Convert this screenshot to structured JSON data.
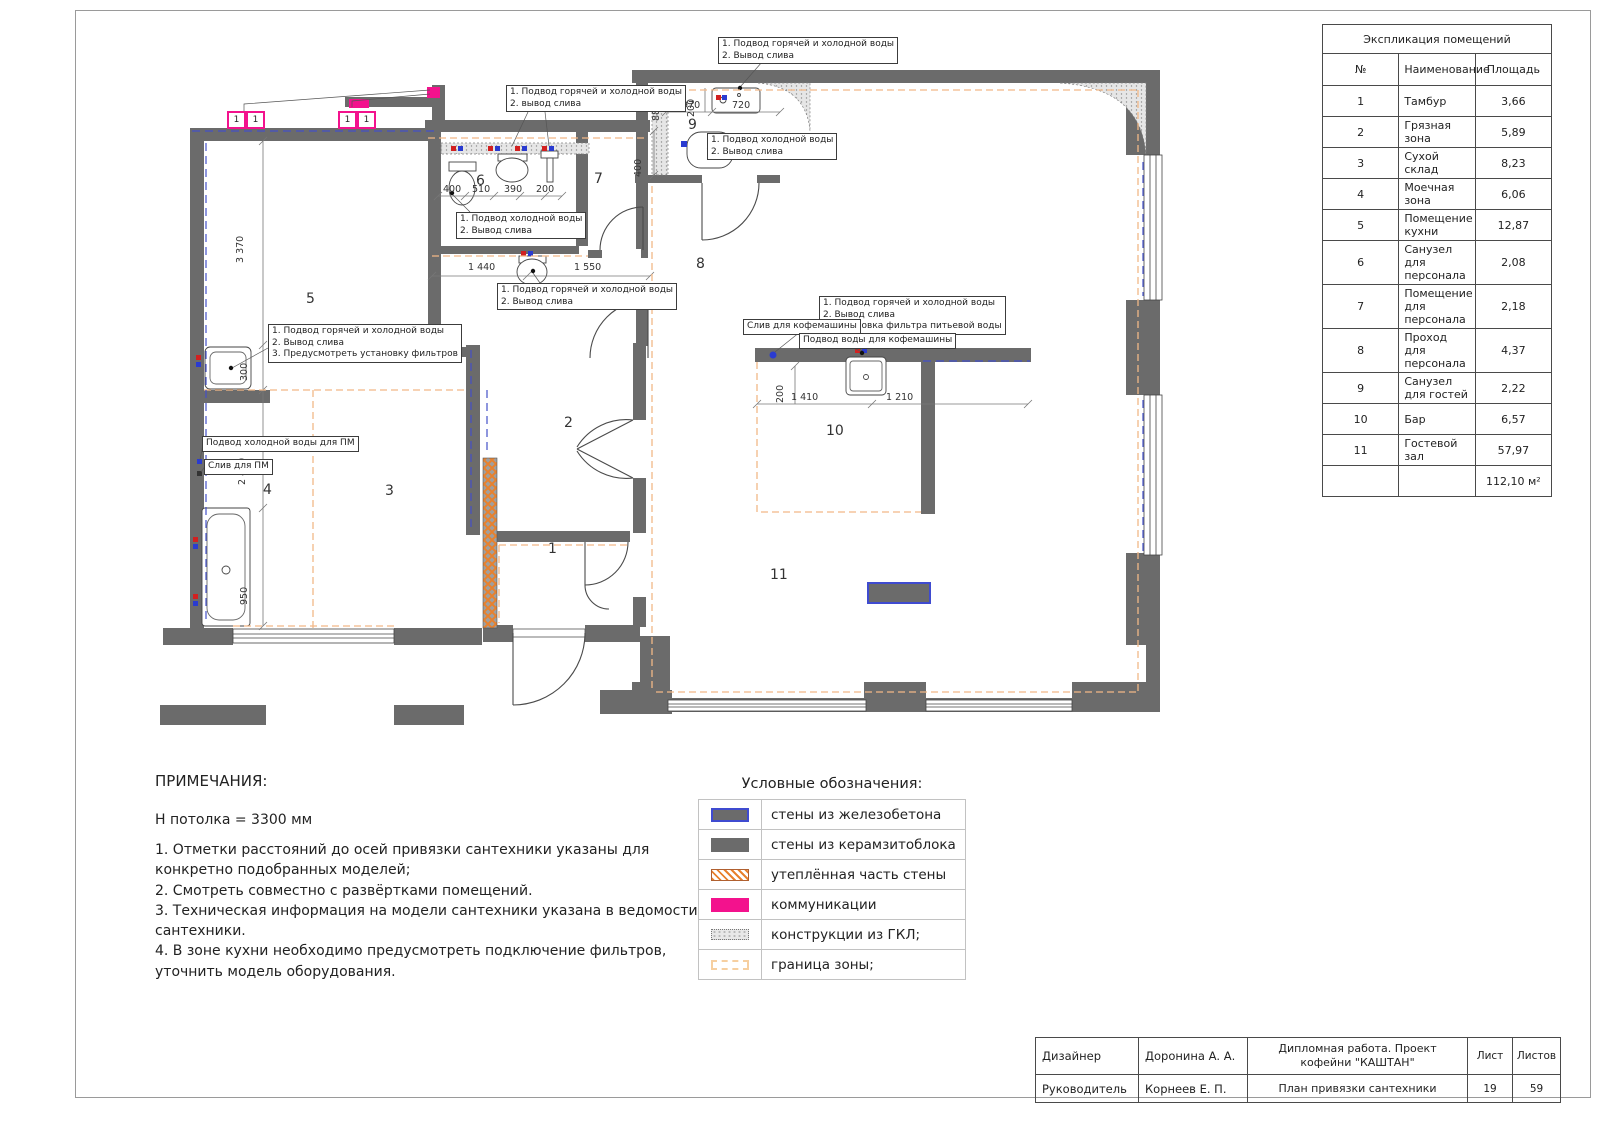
{
  "explication": {
    "title": "Экспликация помещений",
    "columns": [
      "№",
      "Наименование",
      "Площадь"
    ],
    "rows": [
      [
        "1",
        "Тамбур",
        "3,66"
      ],
      [
        "2",
        "Грязная зона",
        "5,89"
      ],
      [
        "3",
        "Сухой склад",
        "8,23"
      ],
      [
        "4",
        "Моечная зона",
        "6,06"
      ],
      [
        "5",
        "Помещение кухни",
        "12,87"
      ],
      [
        "6",
        "Санузел для персонала",
        "2,08"
      ],
      [
        "7",
        "Помещение для персонала",
        "2,18"
      ],
      [
        "8",
        "Проход для персонала",
        "4,37"
      ],
      [
        "9",
        "Санузел для гостей",
        "2,22"
      ],
      [
        "10",
        "Бар",
        "6,57"
      ],
      [
        "11",
        "Гостевой зал",
        "57,97"
      ]
    ],
    "total": "112,10 м²"
  },
  "notes": {
    "heading": "ПРИМЕЧАНИЯ:",
    "subheading": "Н потолка = 3300 мм",
    "items": [
      "1. Отметки расстояний до осей привязки сантехники указаны для конкретно подобранных моделей;",
      "2. Смотреть совместно с развёртками помещений.",
      "3. Техническая информация на модели сантехники указана в ведомости сантехники.",
      "4. В зоне кухни необходимо предусмотреть подключение фильтров, уточнить модель оборудования."
    ]
  },
  "legend": {
    "title": "Условные обозначения:",
    "items": [
      {
        "swatch": "concrete",
        "label": "стены из железобетона"
      },
      {
        "swatch": "block",
        "label": "стены из керамзитоблока"
      },
      {
        "swatch": "insulated",
        "label": "утеплённая часть стены"
      },
      {
        "swatch": "comms",
        "label": "коммуникации"
      },
      {
        "swatch": "gkl",
        "label": "конструкции из ГКЛ;"
      },
      {
        "swatch": "zone",
        "label": "граница зоны;"
      }
    ]
  },
  "titleblock": {
    "rows": [
      {
        "role": "Дизайнер",
        "name": "Доронина А. А.",
        "doc": "Дипломная работа. Проект кофейни \"КАШТАН\"",
        "c4": "Лист",
        "c5": "Листов"
      },
      {
        "role": "Руководитель",
        "name": "Корнеев Е. П.",
        "doc": "План привязки сантехники",
        "c4": "19",
        "c5": "59"
      }
    ]
  },
  "plan": {
    "room_labels": [
      {
        "n": "1",
        "x": 548,
        "y": 541
      },
      {
        "n": "2",
        "x": 564,
        "y": 415
      },
      {
        "n": "3",
        "x": 385,
        "y": 483
      },
      {
        "n": "4",
        "x": 263,
        "y": 482
      },
      {
        "n": "5",
        "x": 306,
        "y": 291
      },
      {
        "n": "6",
        "x": 476,
        "y": 173
      },
      {
        "n": "7",
        "x": 594,
        "y": 171
      },
      {
        "n": "8",
        "x": 696,
        "y": 256
      },
      {
        "n": "9",
        "x": 688,
        "y": 117
      },
      {
        "n": "10",
        "x": 826,
        "y": 423
      },
      {
        "n": "11",
        "x": 770,
        "y": 567
      }
    ],
    "dimensions": [
      {
        "t": "3 370",
        "x": 246,
        "y": 252,
        "v": 1
      },
      {
        "t": "300",
        "x": 250,
        "y": 370,
        "v": 1
      },
      {
        "t": "2 460",
        "x": 248,
        "y": 474,
        "v": 1
      },
      {
        "t": "950",
        "x": 250,
        "y": 594,
        "v": 1
      },
      {
        "t": "400",
        "x": 443,
        "y": 184
      },
      {
        "t": "510",
        "x": 472,
        "y": 184
      },
      {
        "t": "390",
        "x": 504,
        "y": 184
      },
      {
        "t": "200",
        "x": 536,
        "y": 184
      },
      {
        "t": "1 440",
        "x": 468,
        "y": 262
      },
      {
        "t": "1 550",
        "x": 574,
        "y": 262
      },
      {
        "t": "880",
        "x": 662,
        "y": 110,
        "v": 1
      },
      {
        "t": "200",
        "x": 697,
        "y": 106,
        "v": 1
      },
      {
        "t": "970",
        "x": 682,
        "y": 100
      },
      {
        "t": "720",
        "x": 732,
        "y": 100
      },
      {
        "t": "400",
        "x": 644,
        "y": 166,
        "v": 1
      },
      {
        "t": "200",
        "x": 786,
        "y": 392,
        "v": 1
      },
      {
        "t": "1 410",
        "x": 791,
        "y": 392
      },
      {
        "t": "1 210",
        "x": 886,
        "y": 392
      }
    ],
    "callouts": [
      {
        "x": 718,
        "y": 37,
        "lines": [
          "1. Подвод горячей и холодной воды",
          "2. Вывод слива"
        ]
      },
      {
        "x": 506,
        "y": 85,
        "lines": [
          "1. Подвод горячей и холодной воды",
          "2. вывод слива"
        ]
      },
      {
        "x": 707,
        "y": 133,
        "lines": [
          "1. Подвод холодной воды",
          "2. Вывод слива"
        ]
      },
      {
        "x": 456,
        "y": 212,
        "lines": [
          "1. Подвод холодной воды",
          "2. Вывод слива"
        ]
      },
      {
        "x": 497,
        "y": 283,
        "lines": [
          "1. Подвод горячей и холодной воды",
          "2. Вывод слива"
        ]
      },
      {
        "x": 268,
        "y": 324,
        "lines": [
          "1. Подвод горячей и холодной воды",
          "2. Вывод слива",
          "3. Предусмотреть установку фильтров"
        ]
      },
      {
        "x": 202,
        "y": 436,
        "lines": [
          "Подвод холодной воды для ПМ"
        ]
      },
      {
        "x": 204,
        "y": 459,
        "lines": [
          "Слив для ПМ"
        ]
      },
      {
        "x": 819,
        "y": 296,
        "lines": [
          "1. Подвод горячей и холодной воды",
          "2. Вывод слива",
          "3. Установка фильтра питьевой воды"
        ]
      },
      {
        "x": 743,
        "y": 319,
        "lines": [
          "Слив для кофемашины"
        ]
      },
      {
        "x": 799,
        "y": 333,
        "lines": [
          "Подвод воды для кофемашины"
        ]
      }
    ],
    "risers": [
      {
        "x": 227,
        "y": 111,
        "label": "1"
      },
      {
        "x": 246,
        "y": 111,
        "label": "1"
      },
      {
        "x": 338,
        "y": 111,
        "label": "1"
      },
      {
        "x": 357,
        "y": 111,
        "label": "1"
      }
    ]
  },
  "colors": {
    "wall_gray": "#6b6b6b",
    "comms_pink": "#f3128d",
    "concrete_blue": "#3f4bd0",
    "insulation_orange": "#e8812d",
    "zone_orange": "#f2b887",
    "supply_hot": "#d22020",
    "supply_cold": "#2a3bd0"
  }
}
